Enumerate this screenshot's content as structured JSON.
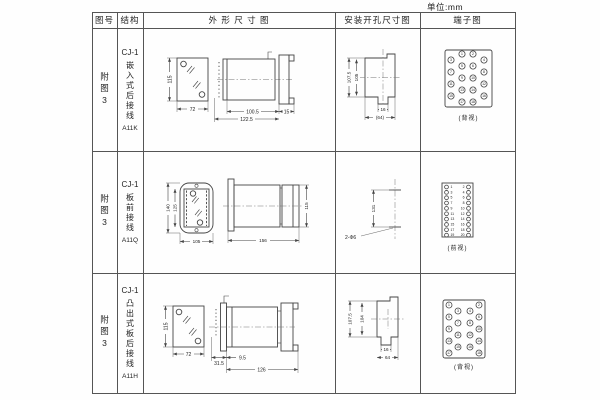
{
  "unit_label": "单位:mm",
  "header": {
    "figure": "图号",
    "structure": "结构",
    "outline": "外 形 尺 寸 图",
    "mounting": "安装开孔尺寸图",
    "terminal": "端子图"
  },
  "rows": [
    {
      "figure": "附图3",
      "model": "CJ-1",
      "desc": "嵌入式后接线",
      "code": "A11K",
      "outline": {
        "front_h": "115",
        "front_w": "72",
        "body_d": "100.5",
        "total_d": "122.5",
        "flange_d": "15"
      },
      "mounting": {
        "outer": "107.5",
        "inner": "105",
        "notch": "16",
        "width": "(64)"
      },
      "terminal": {
        "view": "(背视)",
        "numbers": [
          1,
          2,
          3,
          4,
          5,
          6,
          7,
          8,
          9,
          10,
          11,
          12,
          13,
          14,
          15,
          16,
          17,
          18
        ]
      }
    },
    {
      "figure": "附图3",
      "model": "CJ-1",
      "desc": "板前接线",
      "code": "A11Q",
      "outline": {
        "front_h": "140",
        "inner_h": "125",
        "front_w": "105",
        "side_w": "156",
        "side_h": "115"
      },
      "mounting": {
        "pitch": "131",
        "holes": "2-Φ6"
      },
      "terminal": {
        "view": "(前视)",
        "left": [
          1,
          3,
          5,
          7,
          9,
          11,
          13,
          15,
          17,
          19
        ],
        "right": [
          2,
          4,
          6,
          8,
          10,
          12,
          14,
          16,
          18,
          20
        ]
      }
    },
    {
      "figure": "附图3",
      "model": "CJ-1",
      "desc": "凸出式板后接线",
      "code": "A11H",
      "outline": {
        "front_h": "115",
        "front_w": "72",
        "pin_d": "31.5",
        "offset_d": "9.5",
        "body_d": "126"
      },
      "mounting": {
        "outer": "107.5",
        "inner": "104",
        "notch": "16",
        "width": "64"
      },
      "terminal": {
        "view": "(背视)",
        "numbers": [
          1,
          2,
          3,
          4,
          5,
          6,
          7,
          8,
          9,
          10,
          11,
          12,
          13,
          14,
          15,
          16,
          17,
          18
        ]
      }
    }
  ]
}
